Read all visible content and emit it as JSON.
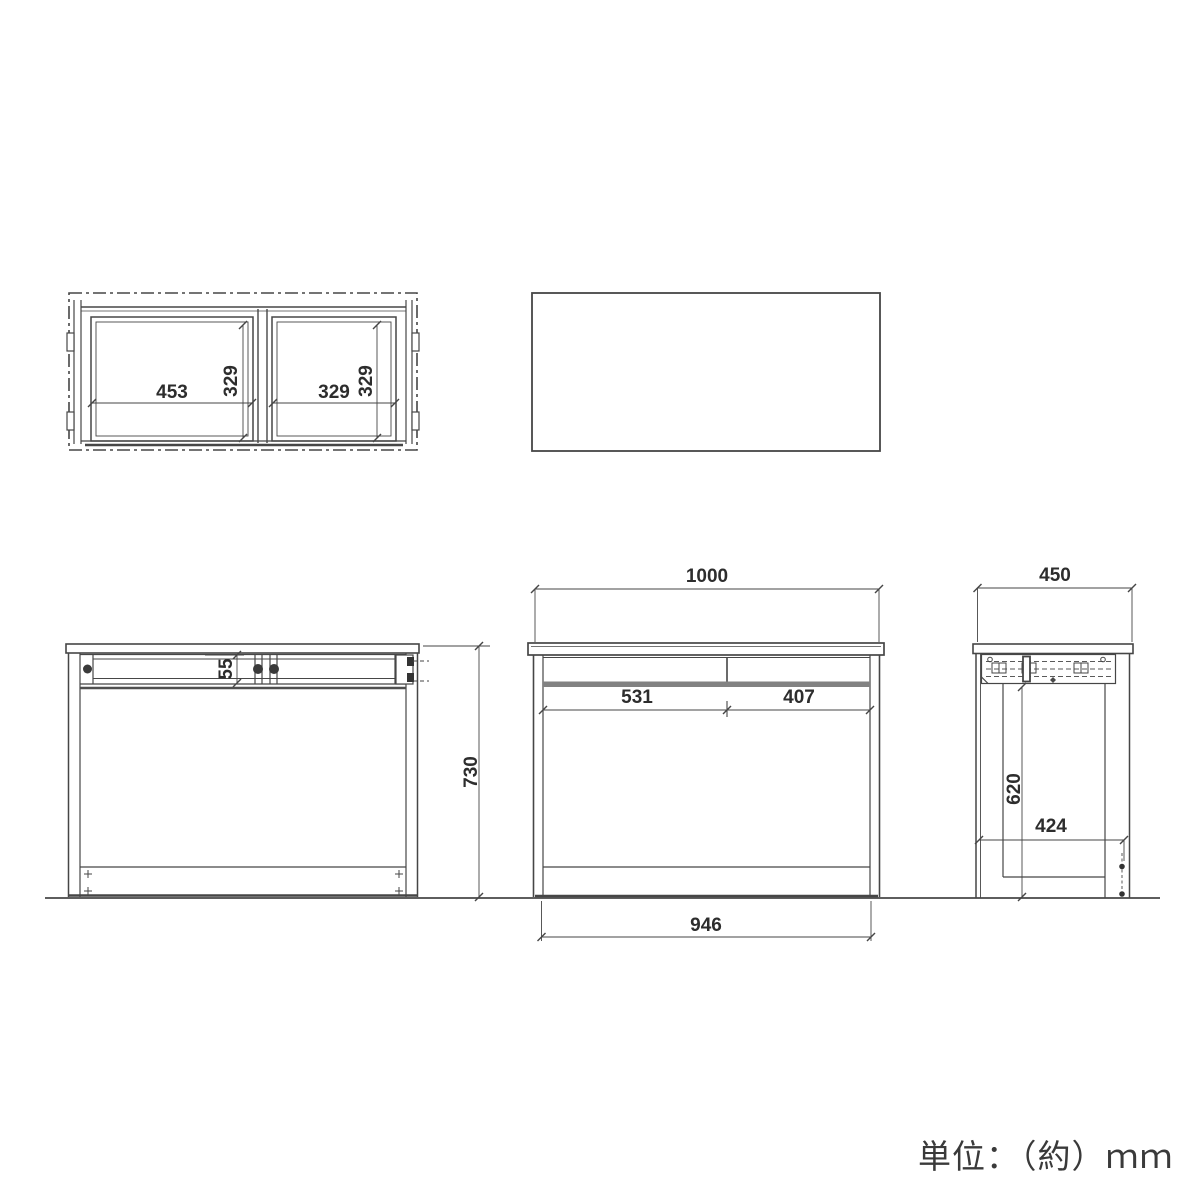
{
  "unit_note": "単位：（約）ｍｍ",
  "plan_view": {
    "left_compartment_width": "453",
    "left_compartment_depth": "329",
    "right_compartment_width": "329",
    "right_compartment_depth": "329"
  },
  "rear_view": {
    "rail_height": "55",
    "overall_height": "730"
  },
  "front_view": {
    "overall_width": "1000",
    "left_drawer_width": "531",
    "right_drawer_width": "407",
    "inner_width": "946"
  },
  "side_view": {
    "overall_depth": "450",
    "under_rail_height": "620",
    "inner_depth": "424"
  }
}
